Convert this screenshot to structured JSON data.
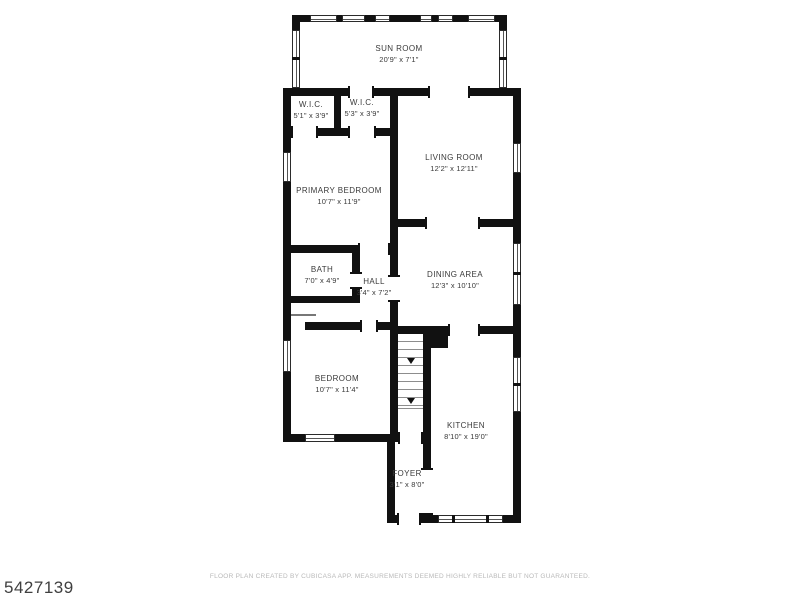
{
  "meta": {
    "listing_id": "5427139",
    "disclaimer": "FLOOR PLAN CREATED BY CUBICASA APP. MEASUREMENTS DEEMED HIGHLY RELIABLE BUT NOT GUARANTEED."
  },
  "colors": {
    "wall": "#111111",
    "background": "#ffffff",
    "room_label": "#3a3a3a",
    "disclaimer_text": "#b9b9b9",
    "listing_id_text": "#3f3f3f"
  },
  "rooms": [
    {
      "name": "SUN ROOM",
      "dims": "20'9\" x 7'1\""
    },
    {
      "name": "W.I.C.",
      "dims": "5'1\" x 3'9\""
    },
    {
      "name": "W.I.C.",
      "dims": "5'3\" x 3'9\""
    },
    {
      "name": "LIVING ROOM",
      "dims": "12'2\" x 12'11\""
    },
    {
      "name": "PRIMARY BEDROOM",
      "dims": "10'7\" x 11'9\""
    },
    {
      "name": "BATH",
      "dims": "7'0\" x 4'9\""
    },
    {
      "name": "HALL",
      "dims": "3'4\" x 7'2\""
    },
    {
      "name": "DINING AREA",
      "dims": "12'3\" x 10'10\""
    },
    {
      "name": "BEDROOM",
      "dims": "10'7\" x 11'4\""
    },
    {
      "name": "KITCHEN",
      "dims": "8'10\" x 19'0\""
    },
    {
      "name": "FOYER",
      "dims": "3'1\" x 8'0\""
    }
  ]
}
